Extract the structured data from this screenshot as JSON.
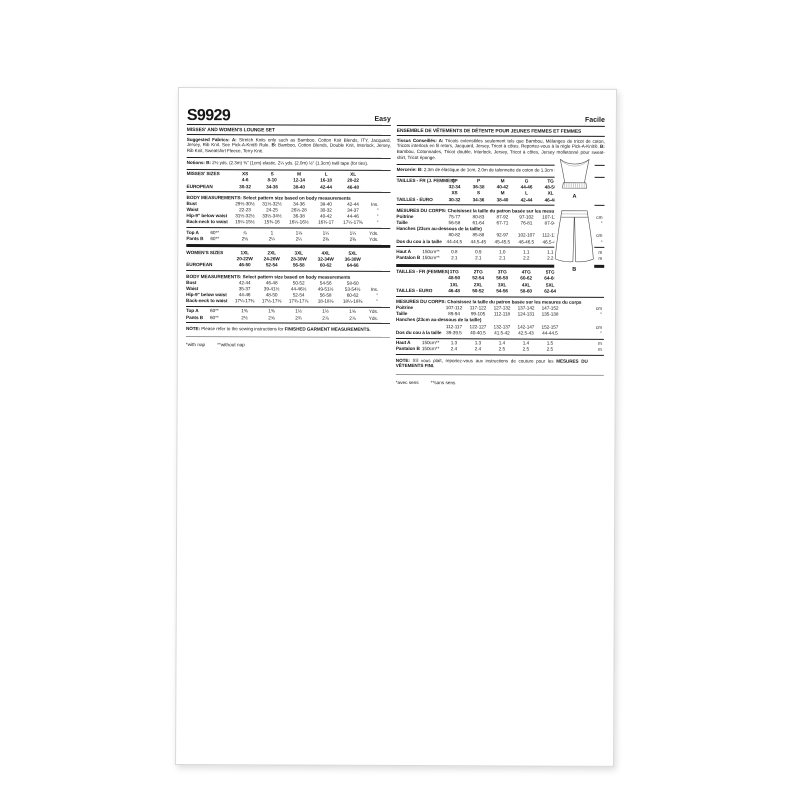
{
  "sheet": {
    "sku": "S9929",
    "difficulty_en": "Easy",
    "difficulty_fr": "Facile"
  },
  "views": {
    "a": "A",
    "b": "B"
  },
  "en": {
    "title": "MISSES' AND WOMEN'S LOUNGE SET",
    "fabrics_b1": "Suggested Fabrics: A:",
    "fabrics_t1": "Stretch Knits only such as Bamboo, Cotton Knit Blends, ITY, Jacquard, Jersey, Rib Knit. See Pick-A-Knit® Rule.",
    "fabrics_b2": "B:",
    "fabrics_t2": "Bamboo, Cotton Blends, Double Knit, Interlock, Jersey, Rib Knit, Sweatshirt Fleece, Terry Knit.",
    "notions_b": "Notions: B:",
    "notions_t": "2½ yds. (2.3m) ⅜\" (1cm) elastic, 2¼ yds. (2.0m) ½\" (1.3cm) twill tape (for ties).",
    "body_title": "BODY MEASUREMENTS: Select pattern size based on body measurements",
    "misses_sizes": [
      {
        "label": "MISSES' SIZES",
        "values": [
          "XS",
          "S",
          "M",
          "L",
          "XL"
        ],
        "unit": "",
        "cls": "b"
      },
      {
        "label": "",
        "values": [
          "4-6",
          "8-10",
          "12-14",
          "16-18",
          "20-22"
        ],
        "unit": "",
        "cls": "b"
      },
      {
        "label": "EUROPEAN",
        "values": [
          "30-32",
          "34-36",
          "38-40",
          "42-44",
          "46-48"
        ],
        "unit": "",
        "cls": "b"
      }
    ],
    "misses_body": [
      {
        "label": "Bust",
        "values": [
          "29½-30½",
          "31½-32½",
          "34-36",
          "38-40",
          "42-44"
        ],
        "unit": "Ins."
      },
      {
        "label": "Waist",
        "values": [
          "22-23",
          "24-25",
          "26½-28",
          "30-32",
          "34-37"
        ],
        "unit": "\""
      },
      {
        "label": "Hip-9\" below waist",
        "values": [
          "31½-32½",
          "33½-34½",
          "36-38",
          "40-42",
          "44-46"
        ],
        "unit": "\""
      },
      {
        "label": "Back-neck to waist",
        "values": [
          "15¼-15½",
          "15¾-16",
          "16¼-16½",
          "16¾-17",
          "17¼-17⅜"
        ],
        "unit": "\""
      }
    ],
    "misses_yardage": [
      {
        "label": "Top A",
        "width": "60**",
        "values": [
          "⅞",
          "1",
          "1⅛",
          "1¼",
          "1¼"
        ],
        "unit": "Yds.",
        "cls": "y"
      },
      {
        "label": "Pants B",
        "width": "60**",
        "values": [
          "2⅛",
          "2¼",
          "2¼",
          "2⅜",
          "2⅜"
        ],
        "unit": "Yds.",
        "cls": "y"
      }
    ],
    "women_sizes": [
      {
        "label": "WOMEN'S SIZES",
        "values": [
          "1XL",
          "2XL",
          "3XL",
          "4XL",
          "5XL"
        ],
        "unit": "",
        "cls": "b"
      },
      {
        "label": "",
        "values": [
          "20-22W",
          "24-26W",
          "28-30W",
          "32-34W",
          "36-38W"
        ],
        "unit": "",
        "cls": "b"
      },
      {
        "label": "EUROPEAN",
        "values": [
          "46-50",
          "52-54",
          "56-58",
          "60-62",
          "64-66"
        ],
        "unit": "",
        "cls": "b"
      }
    ],
    "women_body": [
      {
        "label": "Bust",
        "values": [
          "42-44",
          "46-48",
          "50-52",
          "54-56",
          "58-60"
        ],
        "unit": ""
      },
      {
        "label": "Waist",
        "values": [
          "35-37",
          "39-41½",
          "44-46½",
          "49-51½",
          "53-54½"
        ],
        "unit": "Ins."
      },
      {
        "label": "Hip-9\" below waist",
        "values": [
          "44-46",
          "48-50",
          "52-54",
          "56-58",
          "60-62"
        ],
        "unit": "\""
      },
      {
        "label": "Back-neck to waist",
        "values": [
          "17¼-17⅜",
          "17½-17⅝",
          "17¾-17⅞",
          "18-18⅛",
          "18¼-18⅜"
        ],
        "unit": "\""
      }
    ],
    "women_yardage": [
      {
        "label": "Top A",
        "width": "60**",
        "values": [
          "1⅜",
          "1⅜",
          "1½",
          "1½",
          "1⅝"
        ],
        "unit": "Yds.",
        "cls": "y"
      },
      {
        "label": "Pants B",
        "width": "60**",
        "values": [
          "2½",
          "2⅝",
          "2¾",
          "2⅞",
          "2⅞"
        ],
        "unit": "Yds.",
        "cls": "y"
      }
    ],
    "note_b": "NOTE:",
    "note_t": "Please refer to the sewing instructions for",
    "note_e": "FINISHED GARMENT MEASUREMENTS.",
    "foot1": "*with nap",
    "foot2": "**without nap"
  },
  "fr": {
    "title": "ENSEMBLE DE VÊTEMENTS DE DÉTENTE POUR JEUNES FEMMES ET FEMMES",
    "fabrics_b1": "Tissus Conseillés: A:",
    "fabrics_t1": "Tricots extensibles seulement tels que Bambou, Mélanges de tricot de coton, Tricots interlock en fil retors, Jacquard, Jersey, Tricot à côtes. Reportez-vous à la règle Pick-A-Knit®.",
    "fabrics_b2": "B:",
    "fabrics_t2": "Bambou, Cotonnades, Tricot double, Interlock, Jersey, Tricot à côtes, Jersey molletonné pour sweat-shirt, Tricot éponge.",
    "notions_b": "Mercerie: B:",
    "notions_t": "2.3m de élastique de 1cm, 2.0m de talonnette de coton de 1.3cm (pour attaches).",
    "body_title": "MESURES DU CORPS: Choisissez la taille du patron basée sur les mesures du corps",
    "misses_sizes": [
      {
        "label": "TAILLES - FR (J. FEMMES)",
        "values": [
          "TP",
          "P",
          "M",
          "G",
          "TG"
        ],
        "unit": "",
        "cls": "b"
      },
      {
        "label": "",
        "values": [
          "32-34",
          "36-38",
          "40-42",
          "44-46",
          "48-50"
        ],
        "unit": "",
        "cls": "b"
      },
      {
        "label": "",
        "values": [
          "XS",
          "S",
          "M",
          "L",
          "XL"
        ],
        "unit": "",
        "cls": "b"
      },
      {
        "label": "TAILLES - EURO",
        "values": [
          "30-32",
          "34-36",
          "38-40",
          "42-44",
          "46-48"
        ],
        "unit": "",
        "cls": "b"
      }
    ],
    "misses_body": [
      {
        "label": "Poitrine",
        "values": [
          "75-77",
          "80-83",
          "87-92",
          "97-102",
          "107-112"
        ],
        "unit": "cm"
      },
      {
        "label": "Taille",
        "values": [
          "56-58",
          "61-64",
          "67-71",
          "76-81",
          "87-94"
        ],
        "unit": "\""
      },
      {
        "full": "Hanches (23cm au-dessous de la taille)"
      },
      {
        "label": "",
        "values": [
          "80-82",
          "85-88",
          "92-97",
          "102-107",
          "112-117"
        ],
        "unit": "cm"
      },
      {
        "label": "Dos du cou à la taille",
        "values": [
          "44-44.5",
          "44.5-45",
          "45-45.5",
          "46-46.5",
          "46.5-47"
        ],
        "unit": "\""
      }
    ],
    "misses_yardage": [
      {
        "label": "Haut A",
        "width": "150cm**",
        "values": [
          "0.8",
          "0.9",
          "1.0",
          "1.1",
          "1.1"
        ],
        "unit": "m",
        "cls": "y"
      },
      {
        "label": "Pantalon B",
        "width": "150cm**",
        "values": [
          "2.1",
          "2.1",
          "2.1",
          "2.2",
          "2.2"
        ],
        "unit": "m",
        "cls": "y"
      }
    ],
    "women_sizes": [
      {
        "label": "TAILLES - FR (FEMMES)",
        "values": [
          "1TG",
          "2TG",
          "3TG",
          "4TG",
          "5TG"
        ],
        "unit": "",
        "cls": "b"
      },
      {
        "label": "",
        "values": [
          "48-50",
          "52-54",
          "56-58",
          "60-62",
          "64-66"
        ],
        "unit": "",
        "cls": "b"
      },
      {
        "label": "",
        "values": [
          "1XL",
          "2XL",
          "3XL",
          "4XL",
          "5XL"
        ],
        "unit": "",
        "cls": "b"
      },
      {
        "label": "TAILLES - EURO",
        "values": [
          "46-48",
          "50-52",
          "54-56",
          "58-60",
          "62-64"
        ],
        "unit": "",
        "cls": "b"
      }
    ],
    "women_body": [
      {
        "label": "Poitrine",
        "values": [
          "107-112",
          "117-122",
          "127-132",
          "137-142",
          "147-152"
        ],
        "unit": "cm"
      },
      {
        "label": "Taille",
        "values": [
          "89-94",
          "99-105",
          "112-118",
          "124-131",
          "135-138"
        ],
        "unit": "\""
      },
      {
        "full": "Hanches (23cm au-dessous de la taille)"
      },
      {
        "label": "",
        "values": [
          "112-117",
          "122-127",
          "132-137",
          "142-147",
          "152-157"
        ],
        "unit": "cm"
      },
      {
        "label": "Dos du cou à la taille",
        "values": [
          "39-39.5",
          "40-40.5",
          "41.5-42",
          "42.5-43",
          "44-44.5"
        ],
        "unit": "\""
      }
    ],
    "women_yardage": [
      {
        "label": "Haut A",
        "width": "150cm**",
        "values": [
          "1.3",
          "1.3",
          "1.4",
          "1.4",
          "1.5"
        ],
        "unit": "m",
        "cls": "y"
      },
      {
        "label": "Pantalon B",
        "width": "150cm**",
        "values": [
          "2.4",
          "2.4",
          "2.5",
          "2.5",
          "2.5"
        ],
        "unit": "m",
        "cls": "y"
      }
    ],
    "note_b": "NOTE:",
    "note_t": "S'il vous plaît, reportez-vous aux instructions de couture pour les",
    "note_e": "MESURES DU VÊTEMENTS FINI.",
    "foot1": "*avec sens",
    "foot2": "**sans sens"
  }
}
